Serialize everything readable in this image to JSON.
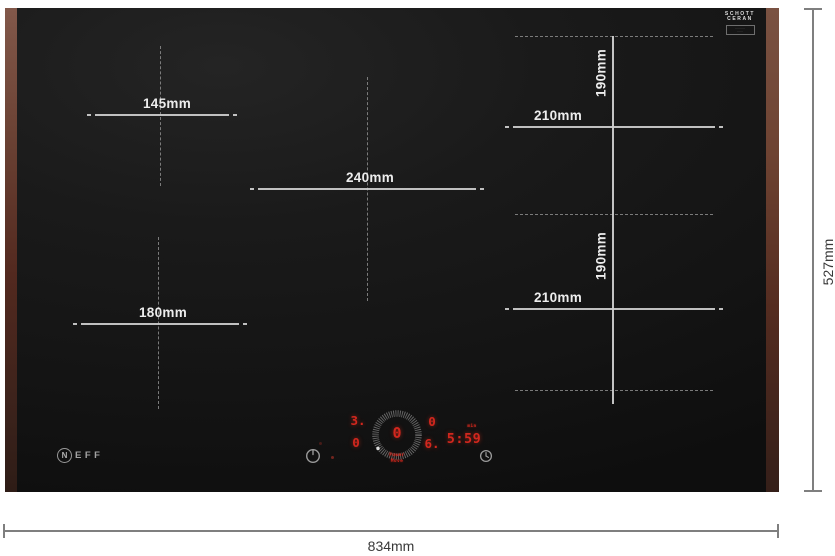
{
  "colors": {
    "background": "#ffffff",
    "glass": "#171717",
    "trim_copper": "#6b4236",
    "measure_line_on_glass": "#cfcfcf",
    "dashed_line": "#8d8d8d",
    "label_on_glass": "#ededed",
    "outer_dimension_line": "#7f7f7f",
    "outer_dimension_text": "#383838",
    "display_red": "#d2271e",
    "icon_gray": "#9a9a9a"
  },
  "brand": {
    "initial": "N",
    "rest": "EFF"
  },
  "glass_badge": {
    "line1": "SCHOTT",
    "line2": "CERAN",
    "micro_line1": "··········",
    "micro_line2": "······"
  },
  "zones": {
    "top_left": {
      "label": "145mm"
    },
    "bottom_left": {
      "label": "180mm"
    },
    "center": {
      "label": "240mm"
    },
    "right_top": {
      "width_label": "210mm",
      "height_label": "190mm"
    },
    "right_bottom": {
      "width_label": "210mm",
      "height_label": "190mm"
    }
  },
  "outer_dimensions": {
    "width_label": "834mm",
    "height_label": "527mm"
  },
  "control_panel": {
    "left_zone_display": {
      "top": "3.",
      "bottom": "0"
    },
    "right_zone_display": {
      "top": "0",
      "bottom": "6."
    },
    "dial_value": "0",
    "dial_caption_line1": "Power",
    "dial_caption_line2": "Move",
    "timer": {
      "value": "5:59",
      "unit": "min"
    }
  }
}
